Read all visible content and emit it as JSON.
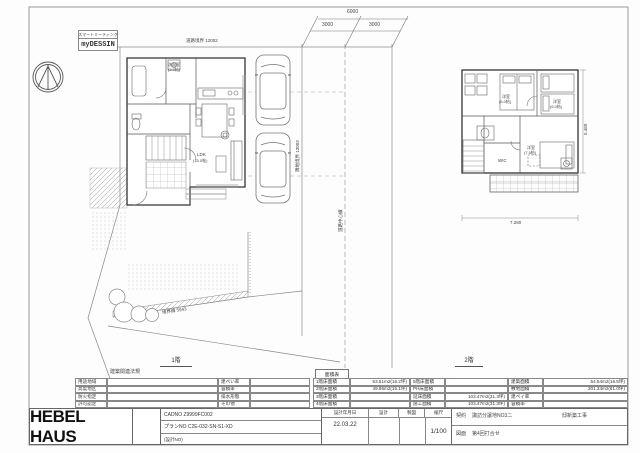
{
  "stamps": {
    "smart_meeting": "スマートミーティング",
    "my_dessin": "myDESSIN"
  },
  "site_plan": {
    "dim_total": "6000",
    "dim_seg1": "3000",
    "dim_seg2": "3000",
    "boundary_top": "道路境界 12002",
    "boundary_east": "隣地境界 13003",
    "road_center": "道路中心線",
    "boundary_south": "境界線 5943",
    "floor1_caption": "1階",
    "floor2_caption": "2階",
    "dim_2f_width": "7.280",
    "dim_2f_height": "5.460",
    "rooms_1f": {
      "wash": "洗面室",
      "wash_size": "(3.0帖)",
      "ldk": "LDK",
      "ldk_size": "(15.0帖)"
    },
    "rooms_2f": {
      "bed1": "洋室",
      "bed1_size": "(6.0帖)",
      "bed2": "洋室",
      "bed2_size": "(6.0帖)",
      "bed3": "洋室",
      "bed3_size": "(7.5帖)",
      "wic": "WIC"
    }
  },
  "regulations": {
    "title": "建築関連法規",
    "rows": [
      {
        "left": "用途地域",
        "right": "建ぺい率"
      },
      {
        "left": "高度地区",
        "right": "容積率"
      },
      {
        "left": "防火指定",
        "right": "排水形態"
      },
      {
        "left": "許可認定",
        "right": "その他"
      }
    ]
  },
  "area_table": {
    "title": "面積表",
    "rows": [
      {
        "a_label": "1階床面積",
        "a_value": "53.51m2(16.2坪)",
        "b_label": "5階床面積",
        "b_value": "",
        "c_label": "建築面積",
        "c_value": "54.54m2(16.5坪)"
      },
      {
        "a_label": "2階床面積",
        "a_value": "49.96m2(15.1坪)",
        "b_label": "PH床面積",
        "b_value": "",
        "c_label": "敷地面積",
        "c_value": "201.34m2(61.0坪)"
      },
      {
        "a_label": "3階床面積",
        "a_value": "",
        "b_label": "延床面積",
        "b_value": "103.47m2(31.3坪)",
        "c_label": "建ペイ率",
        "c_value": ""
      },
      {
        "a_label": "4階床面積",
        "a_value": "",
        "b_label": "施工面積",
        "b_value": "103.47m2(31.3坪)",
        "c_label": "容積率",
        "c_value": ""
      }
    ]
  },
  "title_block": {
    "logo": "HEBEL HAUS",
    "cad_no": "CADNO Z9999FC002",
    "plan_no": "プランNO C2E-032-SN-S1-XD",
    "design_no": "(設計NO)",
    "date_label": "設計年月日",
    "date_value": "22.03.22",
    "design_label": "設計",
    "draft_label": "製図",
    "scale_label": "縮尺",
    "scale_value": "1/100",
    "project_label": "契約",
    "project_value": "諏訪分譲地NO3二",
    "project_suffix": "邸新築工事",
    "drawing_label": "図面",
    "drawing_value": "第4回打合せ"
  }
}
